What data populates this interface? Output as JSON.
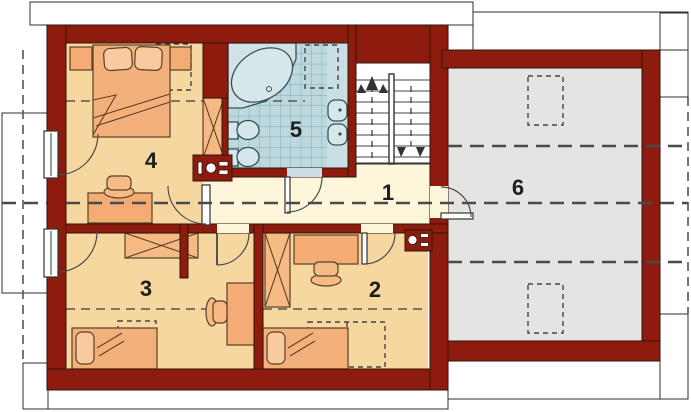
{
  "plan": {
    "type": "floor-plan",
    "rooms": {
      "room1": {
        "label": "1"
      },
      "room2": {
        "label": "2"
      },
      "room3": {
        "label": "3"
      },
      "room4": {
        "label": "4"
      },
      "room5": {
        "label": "5"
      },
      "room6": {
        "label": "6"
      }
    }
  },
  "colors": {
    "wall": "#8e1c0e",
    "bedroom_floor": "#f6d7a0",
    "hall_floor": "#fdf6da",
    "bathroom_tile": "#bdd9de",
    "bathroom_vanity": "#c9dfe4",
    "attic_floor": "#e4e4e2",
    "furniture": "#f3ac74",
    "furniture_light": "#f6ba85",
    "bed": "#f4b07a",
    "pillow": "#f7cb9d",
    "roof": "#cbcbcb",
    "stairs": "#ffffff",
    "outline": "#333333"
  }
}
